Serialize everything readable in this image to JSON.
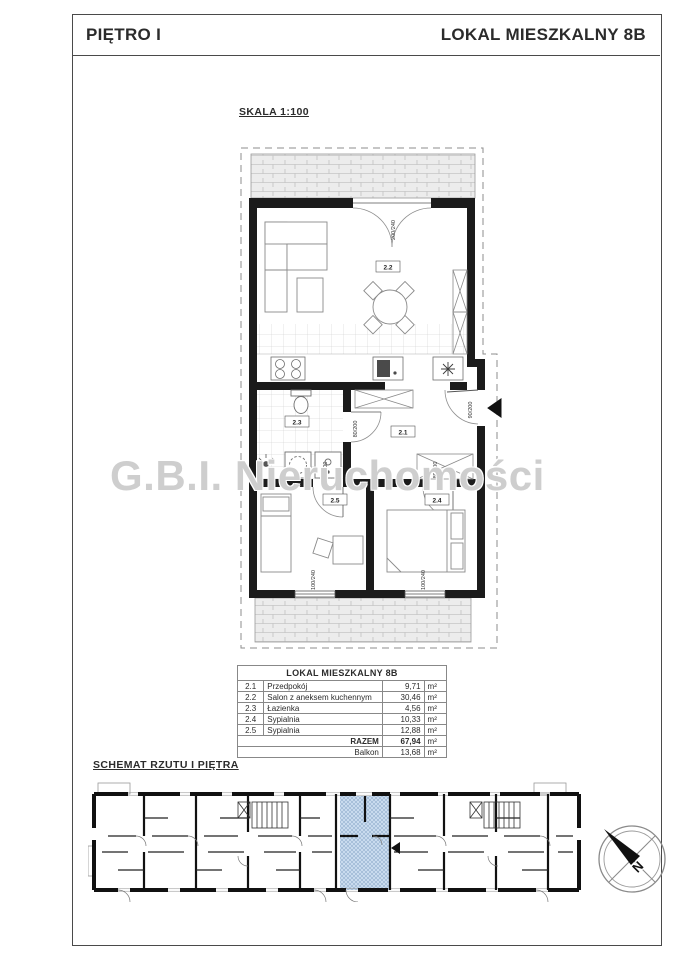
{
  "header": {
    "left": "PIĘTRO I",
    "right": "LOKAL MIESZKALNY 8B"
  },
  "plan": {
    "scale_label": "SKALA 1:100",
    "labels": {
      "living": "2.2",
      "bath": "2.3",
      "hall": "2.1",
      "bed_a": "2.5",
      "bed_b": "2.4"
    },
    "dims": {
      "balcony_door": "200/240",
      "entrance": "90/200",
      "bath_door": "80/200",
      "bed_a_door": "80/200",
      "bed_b_door": "80/200",
      "window_a": "100/240",
      "window_b": "100/240"
    }
  },
  "watermark": "G.B.I. Nieruchomości",
  "area_table": {
    "title": "LOKAL MIESZKALNY 8B",
    "rows": [
      {
        "no": "2.1",
        "name": "Przedpokój",
        "area": "9,71",
        "unit": "m²"
      },
      {
        "no": "2.2",
        "name": "Salon z aneksem kuchennym",
        "area": "30,46",
        "unit": "m²"
      },
      {
        "no": "2.3",
        "name": "Łazienka",
        "area": "4,56",
        "unit": "m²"
      },
      {
        "no": "2.4",
        "name": "Sypialnia",
        "area": "10,33",
        "unit": "m²"
      },
      {
        "no": "2.5",
        "name": "Sypialnia",
        "area": "12,88",
        "unit": "m²"
      }
    ],
    "total": {
      "label": "RAZEM",
      "area": "67,94",
      "unit": "m²"
    },
    "balcony": {
      "label": "Balkon",
      "area": "13,68",
      "unit": "m²"
    }
  },
  "schematic": {
    "title": "SCHEMAT RZUTU I PIĘTRA"
  },
  "compass": {
    "north": "N"
  }
}
